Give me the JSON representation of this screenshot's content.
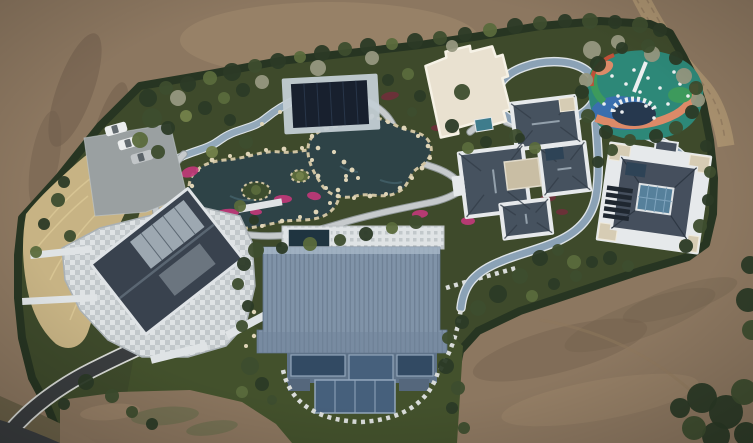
{
  "scene": {
    "title": "Aerial drone photograph of a landscaped private estate under construction",
    "description": "Top-down aerial photo of a walled garden estate surrounded by graded bare earth. A diagonal band of dense green landscaping holds six buildings: a gabled house with a stone plaza (lower left), a dark flat-roofed pool pavilion, a cream flat-roofed annex, two gray hip-roofed villas with courtyards (right), and a large hall with a blue standing-seam metal roof (bottom center). A rock-edged pond garden with winding stone paths and magenta flower beds fills the center-left, a colorful rubber-surfaced playground sits top right inside a tree pocket, a pale blue jogging track loops between the villas, an asphalt driveway curves in from the bottom-left corner past a parking pad with three cars, and a tan dirt track crosses the top-right corner."
  },
  "palette": {
    "earth_mid": "#8c7760",
    "earth_light": "#a18a6d",
    "earth_dark": "#6d5c4a",
    "earth_road": "#a8906e",
    "earth_track": "#8d775c",
    "treeline": "#273522",
    "estate_green": "#3e4a2b",
    "lawn": "#43512c",
    "scrub": "#6b6148",
    "grass_tan": "#c7b384",
    "grass_tan_light": "#d9c795",
    "pond": "#2e4347",
    "pond_light": "#44616a",
    "rock": "#dfd5b8",
    "rock_edge": "#cfc3a2",
    "path_stone": "#c6cacc",
    "path_edge": "#969da1",
    "path_blue": "#93a9ba",
    "track": "#8ba2b6",
    "track_edge": "#dde3e7",
    "plaza_light": "#dfe3e5",
    "plaza_mid": "#c2c8cb",
    "plaza_dark": "#aab1b5",
    "driveway": "#3a3d3f",
    "curb": "#d8dad6",
    "parking": "#9aa0a1",
    "car_white": "#ebeded",
    "car_silver": "#c2c6c8",
    "house_roof": "#39424e",
    "house_ridge": "#5a6672",
    "skylight": "#a9b4bd",
    "eave": "#dfe3e6",
    "pavilion_navy": "#18202e",
    "pavilion_frame": "#c3cdd4",
    "pool_navy": "#1f3440",
    "white_roof": "#e9e1d0",
    "white_roof_trim": "#f6f2e6",
    "teal_annex": "#3e7c8c",
    "villa_roof": "#46525f",
    "villa_roof_dark": "#333d49",
    "villa_ridge": "#93a0ab",
    "villa_trim": "#e6e9eb",
    "court_beige": "#c9bea4",
    "panel_cream": "#d6ccb4",
    "rvilla_roof": "#454f5d",
    "court_glass": "#56809b",
    "glass_mullion": "#7fa3bd",
    "window_dark": "#1f2730",
    "dark_glass": "#2e4356",
    "barn_roof": "#8093a8",
    "barn_rib": "#6e8095",
    "barn_hi": "#a9bac9",
    "barn_shade": "#70839a",
    "facade": "#5f7389",
    "glass_a": "#324a63",
    "glass_b": "#46607c",
    "mullion": "#92a6bb",
    "step_stone": "#d9dcda",
    "play_base": "#2d8878",
    "play_green": "#3d9a5c",
    "play_blue": "#3a6fae",
    "play_salmon": "#dc8a68",
    "play_red": "#c05038",
    "play_navy": "#26384e",
    "play_white": "#eceff0",
    "flower_magenta": "#c03878",
    "flower_maroon": "#6e2f3a",
    "shrub_dark": "#2b3a26",
    "shrub_mid": "#3d4d2e",
    "shrub_olive": "#5a6a3c",
    "shrub_light": "#73814a",
    "tree_bare": "#96977f",
    "green_tinge": "#5e6a46"
  },
  "landmarks": {
    "bare_earth": "Graded bare brown earth surrounding the estate",
    "estate": "Dense evergreen hedge line enclosing the landscaped compound",
    "pond_garden": "Rock-edged dark ponds with islands, stone paths and magenta flower beds",
    "left_house": "Gabled house with dark slate roof, skylights and stone-paved plaza",
    "pool_pavilion": "Dark navy flat-roofed pool pavilion with pale stone apron",
    "white_annex": "Cream flat-roofed annex with small teal outbuilding",
    "center_villa": "Cross-plan villa with gray hip roofs, white trim and beige courtyard",
    "right_villa": "Villa with white flat roof ring, gray hip core and blue glass atrium",
    "blue_hall": "Large hall with ribbed blue standing-seam metal roof and glass facade",
    "playground": "Colorful rubber-surface playground with swirl pattern and play equipment",
    "jogging_track": "Pale blue looping jogging track threading between the villas",
    "driveway": "Dark asphalt driveway curving from the bottom-left corner to the plaza",
    "parking": "Gray parking pad with parked cars",
    "dirt_road": "Tan dirt service road crossing the top-right corner",
    "tall_grass": "Band of tan ornamental tall grass along the western edge",
    "lawn": "Dark green lawn around the blue-roofed hall",
    "corner_trees": "Dark tree clump in the bottom-right corner"
  },
  "vehicles": {
    "count": 3,
    "cars": [
      [
        116,
        129,
        -16,
        "car_white"
      ],
      [
        129,
        143,
        -16,
        "car_white"
      ],
      [
        142,
        157,
        -16,
        "car_silver"
      ]
    ]
  },
  "playground": {
    "label": "playground",
    "equipment_points": [
      [
        612,
        76
      ],
      [
        626,
        84
      ],
      [
        618,
        96
      ],
      [
        640,
        92
      ],
      [
        648,
        78
      ],
      [
        660,
        88
      ],
      [
        668,
        104
      ],
      [
        604,
        104
      ],
      [
        646,
        106
      ],
      [
        680,
        84
      ],
      [
        634,
        70
      ],
      [
        674,
        72
      ],
      [
        688,
        96
      ],
      [
        622,
        112
      ],
      [
        654,
        118
      ]
    ]
  },
  "water": {
    "rock_points": [
      [
        192,
        186,
        2.2
      ],
      [
        198,
        170,
        2
      ],
      [
        212,
        160,
        2.4
      ],
      [
        230,
        156,
        2
      ],
      [
        248,
        154,
        2.3
      ],
      [
        266,
        150,
        2
      ],
      [
        284,
        149,
        2.4
      ],
      [
        302,
        148,
        2
      ],
      [
        318,
        148,
        2.3
      ],
      [
        334,
        152,
        2.1
      ],
      [
        344,
        162,
        2.4
      ],
      [
        346,
        176,
        2
      ],
      [
        338,
        190,
        2.3
      ],
      [
        330,
        203,
        2
      ],
      [
        316,
        212,
        2.4
      ],
      [
        300,
        217,
        2
      ],
      [
        282,
        221,
        2.3
      ],
      [
        262,
        226,
        2
      ],
      [
        242,
        230,
        2.4
      ],
      [
        222,
        228,
        2
      ],
      [
        206,
        220,
        2.3
      ],
      [
        196,
        206,
        2
      ],
      [
        312,
        136,
        2.2
      ],
      [
        324,
        126,
        2
      ],
      [
        340,
        122,
        2.4
      ],
      [
        356,
        118,
        2
      ],
      [
        372,
        116,
        2.3
      ],
      [
        388,
        122,
        2
      ],
      [
        404,
        128,
        2.4
      ],
      [
        418,
        136,
        2
      ],
      [
        428,
        146,
        2.3
      ],
      [
        430,
        158,
        2
      ],
      [
        422,
        168,
        2.4
      ],
      [
        412,
        178,
        2
      ],
      [
        400,
        188,
        2.3
      ],
      [
        386,
        194,
        2
      ],
      [
        370,
        196,
        2.4
      ],
      [
        354,
        198,
        2
      ],
      [
        338,
        196,
        2.3
      ],
      [
        326,
        188,
        2
      ],
      [
        318,
        176,
        2.4
      ],
      [
        312,
        160,
        2
      ],
      [
        246,
        300,
        2.5
      ],
      [
        254,
        312,
        2.2
      ],
      [
        248,
        324,
        2.4
      ],
      [
        254,
        336,
        2.2
      ],
      [
        246,
        346,
        2
      ],
      [
        300,
        96,
        2
      ],
      [
        306,
        102,
        2
      ],
      [
        280,
        112,
        2
      ],
      [
        262,
        124,
        2
      ],
      [
        352,
        170,
        2.5
      ],
      [
        346,
        180,
        2
      ],
      [
        358,
        178,
        2
      ]
    ]
  },
  "vegetation": {
    "flowerbeds": [
      [
        190,
        172,
        9,
        5,
        -20,
        "flower_magenta"
      ],
      [
        226,
        214,
        13,
        5,
        -8,
        "flower_magenta"
      ],
      [
        283,
        199,
        9,
        4,
        0,
        "flower_magenta"
      ],
      [
        314,
        196,
        7,
        4,
        10,
        "flower_magenta"
      ],
      [
        219,
        233,
        9,
        5,
        -15,
        "flower_magenta"
      ],
      [
        170,
        190,
        6,
        4,
        -30,
        "flower_magenta"
      ],
      [
        420,
        214,
        8,
        4,
        -5,
        "flower_magenta"
      ],
      [
        468,
        221,
        7,
        4,
        0,
        "flower_magenta"
      ],
      [
        210,
        226,
        7,
        4,
        -10,
        "flower_magenta"
      ],
      [
        256,
        212,
        6,
        3,
        0,
        "flower_magenta"
      ],
      [
        228,
        244,
        8,
        4,
        -12,
        "flower_magenta"
      ],
      [
        390,
        96,
        9,
        4,
        -10,
        "flower_maroon"
      ],
      [
        437,
        128,
        6,
        3,
        0,
        "flower_maroon"
      ],
      [
        548,
        198,
        8,
        4,
        -8,
        "flower_maroon"
      ],
      [
        562,
        212,
        6,
        3,
        0,
        "flower_maroon"
      ]
    ],
    "shrubs": [
      [
        148,
        98,
        9,
        "shrub_dark"
      ],
      [
        166,
        88,
        7,
        "shrub_mid"
      ],
      [
        188,
        84,
        8,
        "shrub_dark"
      ],
      [
        210,
        78,
        7,
        "shrub_olive"
      ],
      [
        232,
        72,
        9,
        "shrub_dark"
      ],
      [
        255,
        66,
        7,
        "shrub_mid"
      ],
      [
        278,
        61,
        8,
        "shrub_dark"
      ],
      [
        300,
        57,
        6,
        "shrub_olive"
      ],
      [
        322,
        53,
        8,
        "shrub_dark"
      ],
      [
        345,
        49,
        7,
        "shrub_mid"
      ],
      [
        368,
        46,
        8,
        "shrub_dark"
      ],
      [
        392,
        44,
        6,
        "shrub_olive"
      ],
      [
        415,
        41,
        8,
        "shrub_dark"
      ],
      [
        440,
        38,
        7,
        "shrub_mid"
      ],
      [
        465,
        34,
        7,
        "shrub_dark"
      ],
      [
        490,
        30,
        7,
        "shrub_olive"
      ],
      [
        515,
        26,
        8,
        "shrub_dark"
      ],
      [
        540,
        23,
        7,
        "shrub_mid"
      ],
      [
        565,
        21,
        7,
        "shrub_dark"
      ],
      [
        590,
        21,
        8,
        "shrub_mid"
      ],
      [
        615,
        22,
        7,
        "shrub_dark"
      ],
      [
        640,
        25,
        8,
        "shrub_mid"
      ],
      [
        660,
        30,
        7,
        "shrub_dark"
      ],
      [
        178,
        98,
        8,
        "tree_bare"
      ],
      [
        262,
        82,
        7,
        "tree_bare"
      ],
      [
        318,
        68,
        8,
        "tree_bare"
      ],
      [
        372,
        58,
        7,
        "tree_bare"
      ],
      [
        452,
        46,
        6,
        "tree_bare"
      ],
      [
        592,
        50,
        9,
        "tree_bare"
      ],
      [
        618,
        42,
        7,
        "tree_bare"
      ],
      [
        652,
        54,
        8,
        "tree_bare"
      ],
      [
        684,
        76,
        8,
        "tree_bare"
      ],
      [
        698,
        100,
        7,
        "tree_bare"
      ],
      [
        586,
        80,
        7,
        "tree_bare"
      ],
      [
        152,
        118,
        10,
        "shrub_mid"
      ],
      [
        140,
        140,
        8,
        "shrub_olive"
      ],
      [
        168,
        128,
        7,
        "shrub_dark"
      ],
      [
        186,
        116,
        6,
        "shrub_light"
      ],
      [
        158,
        152,
        7,
        "shrub_mid"
      ],
      [
        205,
        108,
        7,
        "shrub_dark"
      ],
      [
        224,
        98,
        6,
        "shrub_olive"
      ],
      [
        243,
        90,
        7,
        "shrub_dark"
      ],
      [
        246,
        142,
        7,
        "shrub_mid"
      ],
      [
        212,
        152,
        6,
        "shrub_light"
      ],
      [
        230,
        120,
        6,
        "shrub_dark"
      ],
      [
        256,
        250,
        8,
        "shrub_mid"
      ],
      [
        282,
        248,
        6,
        "shrub_dark"
      ],
      [
        310,
        244,
        7,
        "shrub_olive"
      ],
      [
        340,
        240,
        6,
        "shrub_mid"
      ],
      [
        366,
        234,
        7,
        "shrub_dark"
      ],
      [
        392,
        228,
        6,
        "shrub_olive"
      ],
      [
        416,
        222,
        7,
        "shrub_mid"
      ],
      [
        244,
        264,
        7,
        "shrub_dark"
      ],
      [
        238,
        284,
        6,
        "shrub_mid"
      ],
      [
        248,
        306,
        6,
        "shrub_dark"
      ],
      [
        242,
        326,
        6,
        "shrub_mid"
      ],
      [
        388,
        80,
        6,
        "shrub_dark"
      ],
      [
        408,
        74,
        6,
        "shrub_olive"
      ],
      [
        420,
        96,
        6,
        "shrub_dark"
      ],
      [
        412,
        112,
        5,
        "shrub_mid"
      ],
      [
        462,
        92,
        8,
        "shrub_mid"
      ],
      [
        452,
        126,
        7,
        "shrub_dark"
      ],
      [
        468,
        148,
        6,
        "shrub_olive"
      ],
      [
        486,
        142,
        6,
        "shrub_dark"
      ],
      [
        516,
        136,
        7,
        "shrub_mid"
      ],
      [
        535,
        148,
        6,
        "shrub_olive"
      ],
      [
        520,
        138,
        5,
        "shrub_dark"
      ],
      [
        540,
        258,
        8,
        "shrub_dark"
      ],
      [
        558,
        250,
        6,
        "shrub_mid"
      ],
      [
        574,
        262,
        7,
        "shrub_olive"
      ],
      [
        592,
        262,
        6,
        "shrub_dark"
      ],
      [
        520,
        276,
        8,
        "shrub_mid"
      ],
      [
        498,
        294,
        9,
        "shrub_dark"
      ],
      [
        478,
        308,
        8,
        "shrub_mid"
      ],
      [
        462,
        322,
        7,
        "shrub_dark"
      ],
      [
        448,
        338,
        6,
        "shrub_mid"
      ],
      [
        532,
        296,
        6,
        "shrub_olive"
      ],
      [
        554,
        284,
        6,
        "shrub_dark"
      ],
      [
        576,
        276,
        6,
        "shrub_mid"
      ],
      [
        610,
        258,
        7,
        "shrub_dark"
      ],
      [
        628,
        266,
        6,
        "shrub_mid"
      ],
      [
        598,
        64,
        8,
        "shrub_dark"
      ],
      [
        582,
        92,
        7,
        "shrub_dark"
      ],
      [
        588,
        116,
        7,
        "shrub_mid"
      ],
      [
        606,
        132,
        7,
        "shrub_dark"
      ],
      [
        630,
        140,
        6,
        "shrub_mid"
      ],
      [
        656,
        136,
        7,
        "shrub_dark"
      ],
      [
        676,
        128,
        7,
        "shrub_mid"
      ],
      [
        692,
        112,
        7,
        "shrub_dark"
      ],
      [
        696,
        88,
        7,
        "shrub_mid"
      ],
      [
        676,
        58,
        7,
        "shrub_dark"
      ],
      [
        648,
        46,
        7,
        "shrub_mid"
      ],
      [
        622,
        48,
        6,
        "shrub_dark"
      ],
      [
        706,
        146,
        6,
        "shrub_dark"
      ],
      [
        710,
        172,
        6,
        "shrub_mid"
      ],
      [
        708,
        200,
        6,
        "shrub_dark"
      ],
      [
        700,
        226,
        7,
        "shrub_mid"
      ],
      [
        686,
        246,
        7,
        "shrub_dark"
      ],
      [
        612,
        150,
        6,
        "shrub_mid"
      ],
      [
        598,
        162,
        6,
        "shrub_dark"
      ],
      [
        250,
        366,
        9,
        "shrub_mid"
      ],
      [
        262,
        384,
        7,
        "shrub_dark"
      ],
      [
        242,
        392,
        6,
        "shrub_olive"
      ],
      [
        272,
        400,
        5,
        "shrub_mid"
      ],
      [
        446,
        366,
        8,
        "shrub_dark"
      ],
      [
        458,
        388,
        7,
        "shrub_mid"
      ],
      [
        452,
        408,
        6,
        "shrub_dark"
      ],
      [
        464,
        428,
        6,
        "shrub_mid"
      ],
      [
        58,
        200,
        7,
        "shrub_mid"
      ],
      [
        44,
        224,
        6,
        "shrub_dark"
      ],
      [
        36,
        252,
        6,
        "shrub_olive"
      ],
      [
        64,
        182,
        6,
        "shrub_dark"
      ],
      [
        70,
        236,
        6,
        "shrub_mid"
      ],
      [
        86,
        382,
        8,
        "shrub_dark"
      ],
      [
        112,
        396,
        7,
        "shrub_mid"
      ],
      [
        64,
        404,
        6,
        "shrub_dark"
      ],
      [
        132,
        412,
        6,
        "shrub_mid"
      ],
      [
        152,
        424,
        6,
        "shrub_dark"
      ],
      [
        240,
        206,
        6,
        "shrub_olive"
      ],
      [
        254,
        220,
        5,
        "shrub_dark"
      ],
      [
        702,
        398,
        15,
        "shrub_dark"
      ],
      [
        726,
        412,
        17,
        "shrub_dark"
      ],
      [
        744,
        392,
        13,
        "shrub_mid"
      ],
      [
        716,
        436,
        14,
        "shrub_dark"
      ],
      [
        746,
        434,
        12,
        "shrub_dark"
      ],
      [
        694,
        428,
        12,
        "shrub_mid"
      ],
      [
        680,
        408,
        10,
        "shrub_dark"
      ],
      [
        748,
        300,
        12,
        "shrub_dark"
      ],
      [
        752,
        330,
        10,
        "shrub_mid"
      ],
      [
        750,
        265,
        9,
        "shrub_dark"
      ],
      [
        256,
        190,
        5,
        "shrub_olive"
      ],
      [
        300,
        176,
        4,
        "shrub_light"
      ]
    ]
  }
}
